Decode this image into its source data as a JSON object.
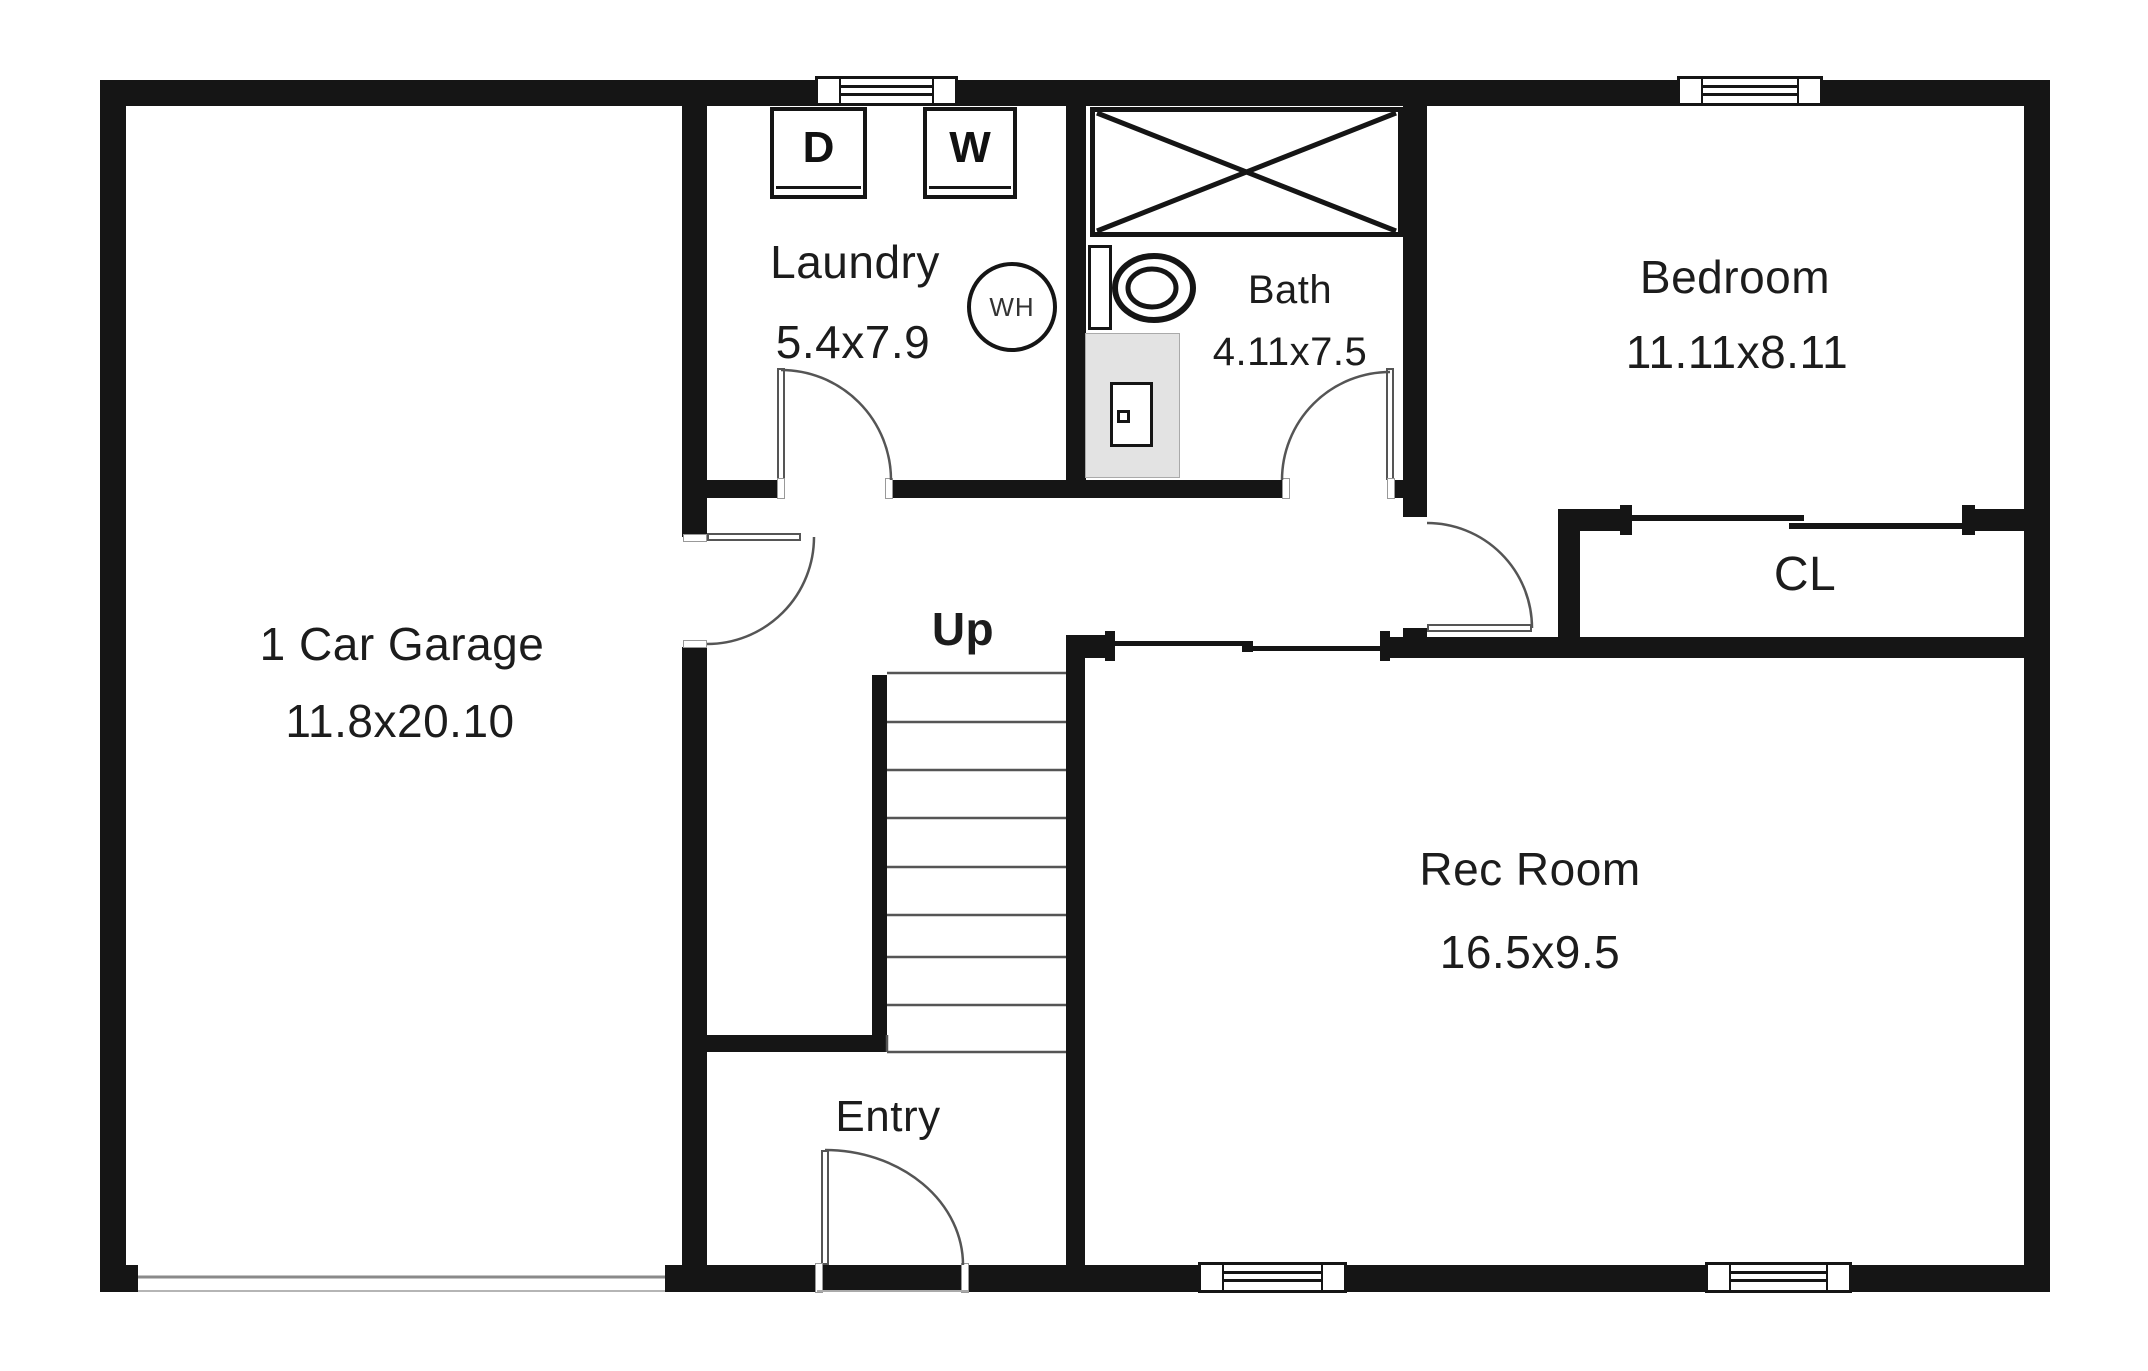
{
  "plan": {
    "title": "Basement floor plan",
    "rooms": {
      "garage": {
        "name": "1 Car Garage",
        "dims": "11.8x20.10"
      },
      "laundry": {
        "name": "Laundry",
        "dims": "5.4x7.9"
      },
      "bath": {
        "name": "Bath",
        "dims": "4.11x7.5"
      },
      "bedroom": {
        "name": "Bedroom",
        "dims": "11.11x8.11"
      },
      "closet": {
        "name": "CL"
      },
      "rec_room": {
        "name": "Rec Room",
        "dims": "16.5x9.5"
      },
      "entry": {
        "name": "Entry"
      }
    },
    "stairs": {
      "direction_label": "Up"
    },
    "fixtures": {
      "dryer_label": "D",
      "washer_label": "W",
      "water_heater_label": "WH"
    },
    "colors": {
      "wall": "#151515",
      "background": "#ffffff",
      "fixture_fill": "#e3e3e3"
    }
  }
}
